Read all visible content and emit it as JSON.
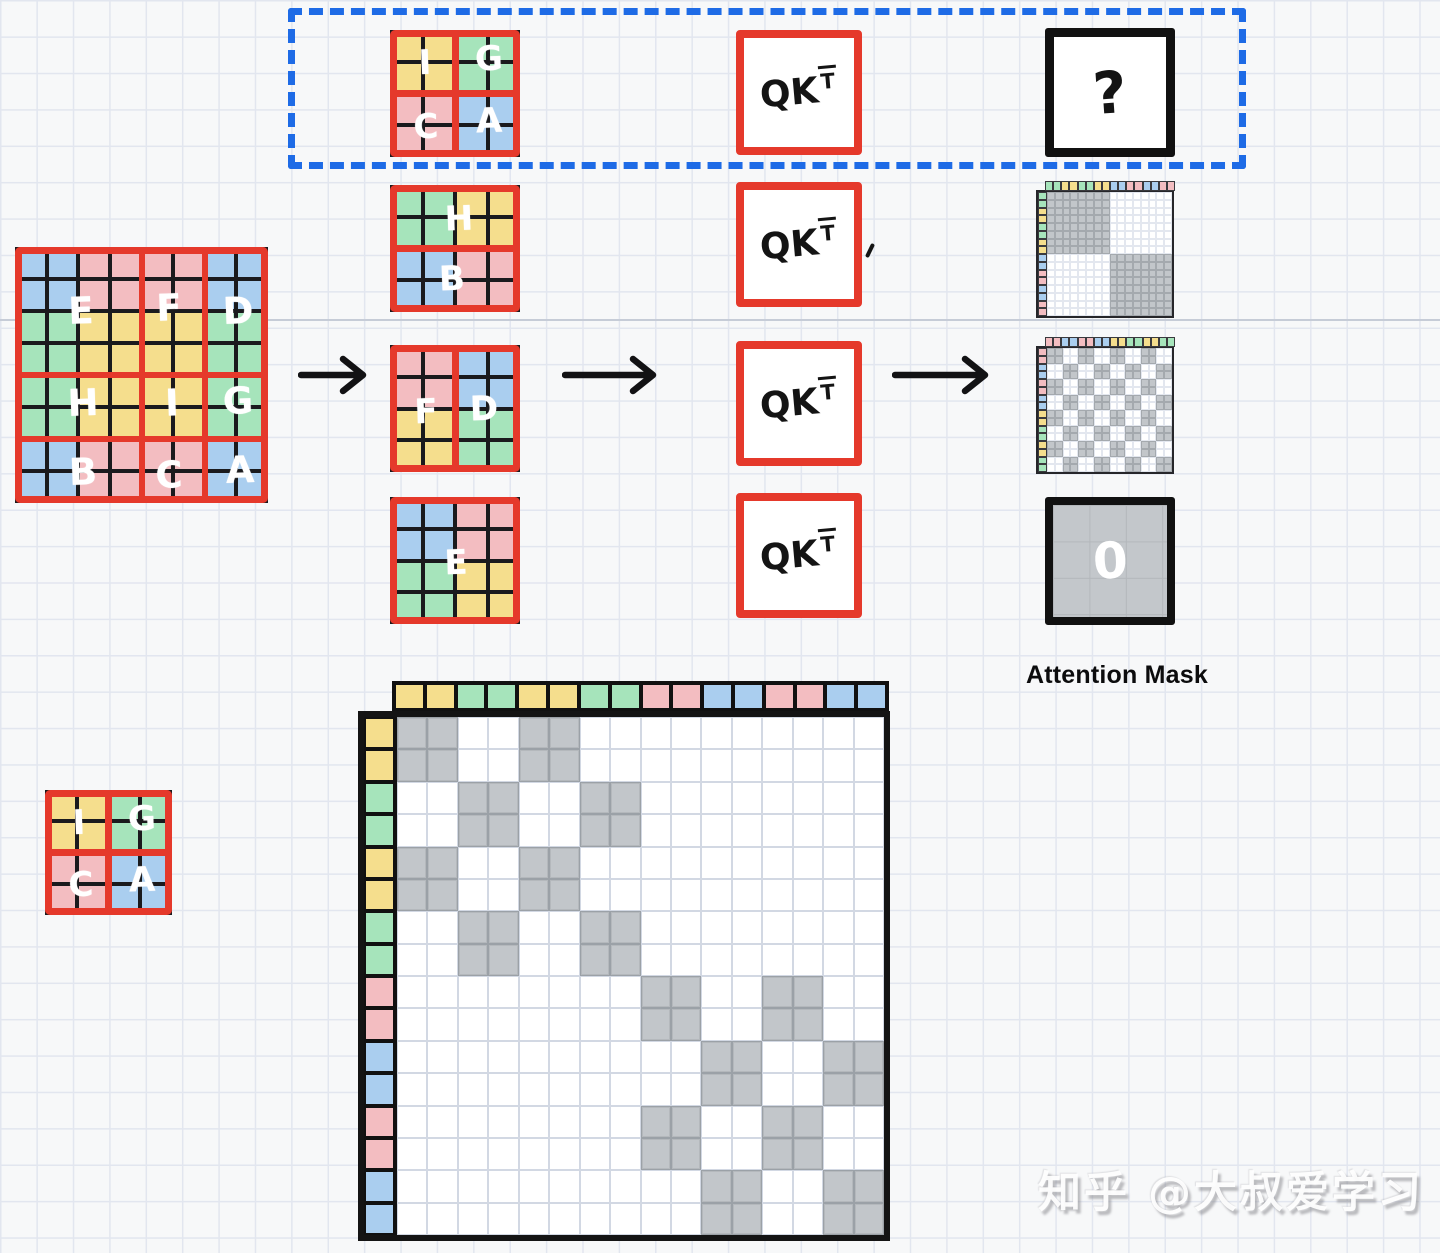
{
  "colors": {
    "cells": {
      "y": "#F5DE8D",
      "g": "#A6E4BB",
      "p": "#F3BDC1",
      "b": "#AACEEF"
    },
    "window_border_red": "#E5392B",
    "line_black": "#151517",
    "mask_gray": "#C2C6CA",
    "dashed_blue": "#1E6BE6"
  },
  "feature_map": {
    "grid_rows": 8,
    "grid_cols": 8,
    "cells": [
      [
        "b",
        "b",
        "p",
        "p",
        "p",
        "p",
        "b",
        "b"
      ],
      [
        "b",
        "b",
        "p",
        "p",
        "p",
        "p",
        "b",
        "b"
      ],
      [
        "g",
        "g",
        "y",
        "y",
        "y",
        "y",
        "g",
        "g"
      ],
      [
        "g",
        "g",
        "y",
        "y",
        "y",
        "y",
        "g",
        "g"
      ],
      [
        "g",
        "g",
        "y",
        "y",
        "y",
        "y",
        "g",
        "g"
      ],
      [
        "g",
        "g",
        "y",
        "y",
        "y",
        "y",
        "g",
        "g"
      ],
      [
        "b",
        "b",
        "p",
        "p",
        "p",
        "p",
        "b",
        "b"
      ],
      [
        "b",
        "b",
        "p",
        "p",
        "p",
        "p",
        "b",
        "b"
      ]
    ],
    "region_labels": [
      {
        "text": "E",
        "x": 26,
        "y": 25
      },
      {
        "text": "F",
        "x": 61,
        "y": 24
      },
      {
        "text": "D",
        "x": 88,
        "y": 25
      },
      {
        "text": "H",
        "x": 27,
        "y": 61
      },
      {
        "text": "I",
        "x": 62,
        "y": 61
      },
      {
        "text": "G",
        "x": 88,
        "y": 60
      },
      {
        "text": "B",
        "x": 27,
        "y": 88
      },
      {
        "text": "C",
        "x": 61,
        "y": 89
      },
      {
        "text": "A",
        "x": 89,
        "y": 87
      }
    ]
  },
  "windows": [
    {
      "name": "window-igca",
      "divider": "cross",
      "quadrants": [
        "y",
        "g",
        "p",
        "b"
      ],
      "letters": [
        {
          "text": "I",
          "x": 27,
          "y": 26
        },
        {
          "text": "G",
          "x": 76,
          "y": 23
        },
        {
          "text": "C",
          "x": 28,
          "y": 76
        },
        {
          "text": "A",
          "x": 76,
          "y": 72
        }
      ]
    },
    {
      "name": "window-hb",
      "divider": "h",
      "quadrants": [
        "g",
        "y",
        "b",
        "p"
      ],
      "letters": [
        {
          "text": "H",
          "x": 53,
          "y": 27
        },
        {
          "text": "B",
          "x": 48,
          "y": 74
        }
      ]
    },
    {
      "name": "window-fd",
      "divider": "v",
      "quadrants": [
        "p",
        "b",
        "y",
        "g"
      ],
      "letters": [
        {
          "text": "F",
          "x": 28,
          "y": 53
        },
        {
          "text": "D",
          "x": 72,
          "y": 50
        }
      ]
    },
    {
      "name": "window-e",
      "divider": "none",
      "quadrants": [
        "b",
        "p",
        "g",
        "y"
      ],
      "letters": [
        {
          "text": "E",
          "x": 51,
          "y": 52
        }
      ]
    }
  ],
  "qkt": {
    "base": "QK",
    "sup": "T"
  },
  "question_box": {
    "label": "?"
  },
  "zero_box": {
    "label": "0"
  },
  "labels": {
    "attention_mask": "Attention Mask",
    "watermark": "知乎 @大叔爱学习"
  },
  "small_masks": [
    {
      "name": "mask-hb",
      "pattern": "block-diagonal",
      "strip": [
        "g",
        "g",
        "y",
        "y",
        "g",
        "g",
        "y",
        "y",
        "b",
        "b",
        "p",
        "p",
        "b",
        "b",
        "p",
        "p"
      ]
    },
    {
      "name": "mask-fd",
      "pattern": "checker-2x2",
      "strip": [
        "p",
        "p",
        "b",
        "b",
        "p",
        "p",
        "b",
        "b",
        "y",
        "y",
        "g",
        "g",
        "y",
        "y",
        "g",
        "g"
      ]
    }
  ],
  "big_mask": {
    "pattern": "same-region",
    "strip": [
      "y",
      "y",
      "g",
      "g",
      "y",
      "y",
      "g",
      "g",
      "p",
      "p",
      "b",
      "b",
      "p",
      "p",
      "b",
      "b"
    ],
    "token_regions": [
      "I",
      "I",
      "G",
      "G",
      "I",
      "I",
      "G",
      "G",
      "C",
      "C",
      "A",
      "A",
      "C",
      "C",
      "A",
      "A"
    ]
  }
}
